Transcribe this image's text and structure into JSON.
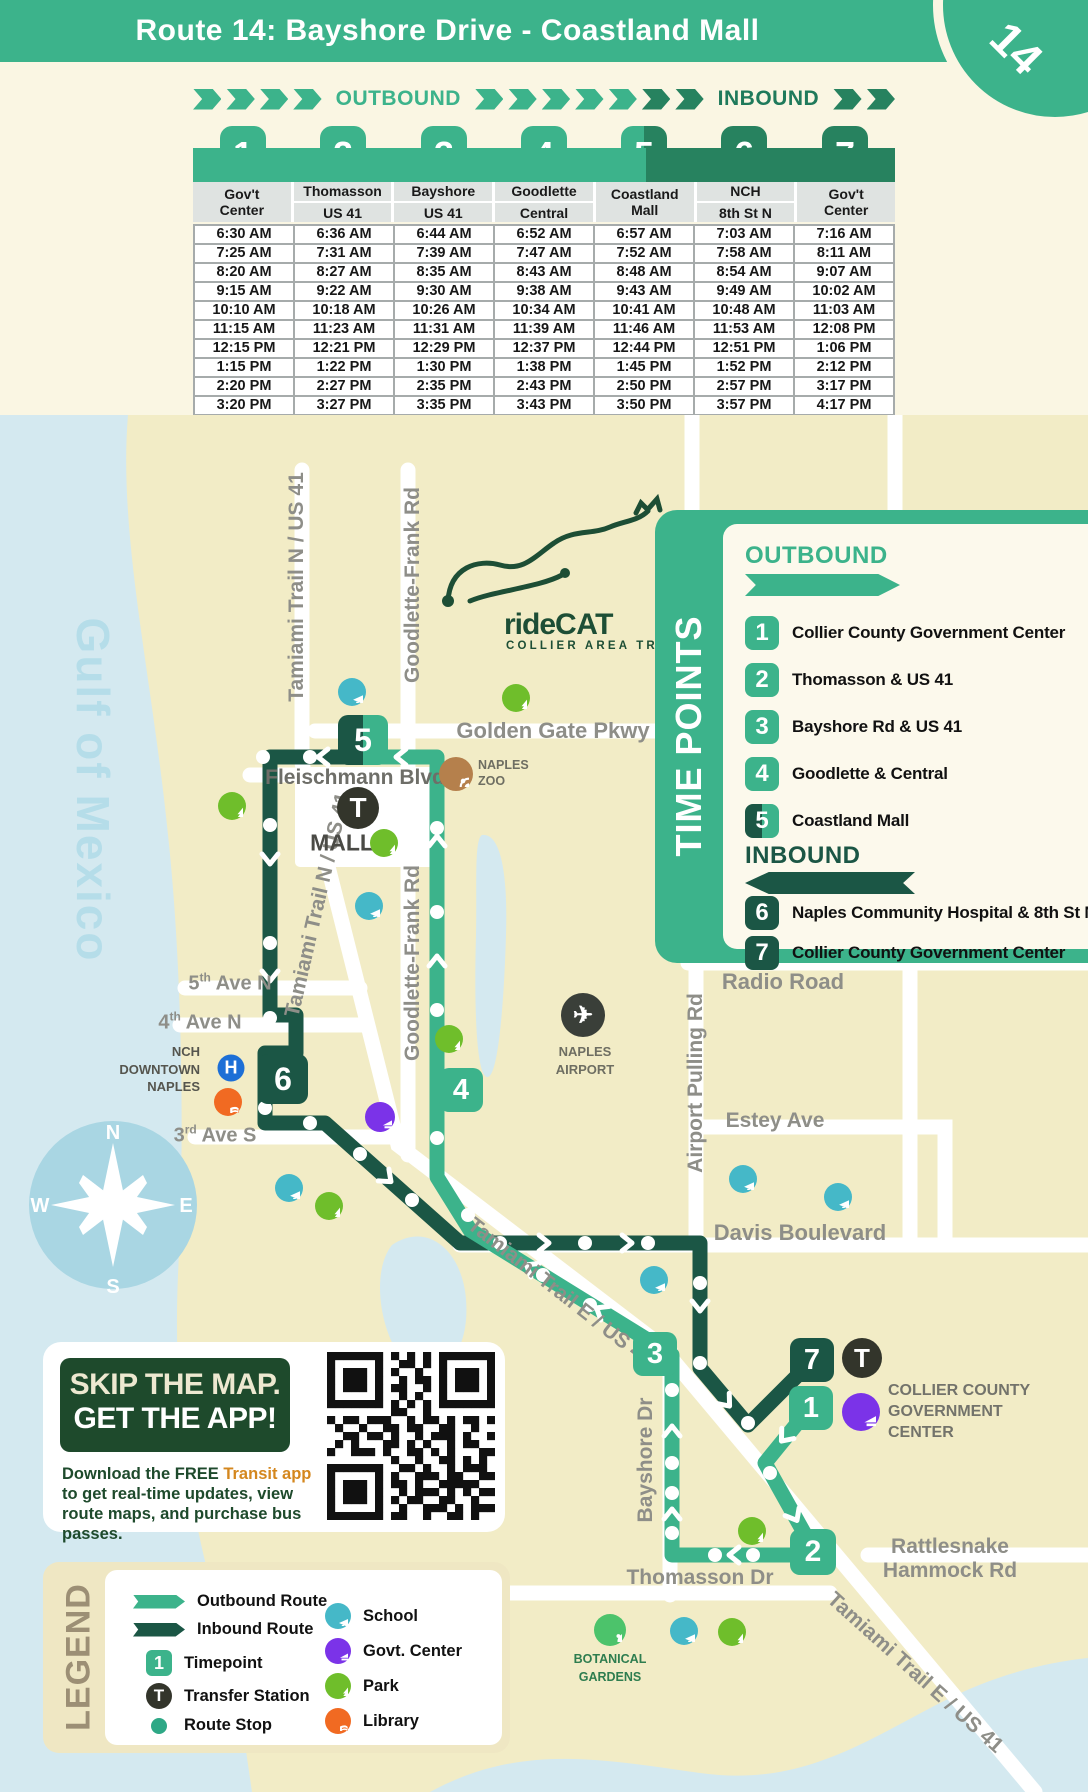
{
  "header": {
    "title": "Route 14: Bayshore Drive - Coastland Mall",
    "route_number": "14"
  },
  "directions": {
    "outbound": "OUTBOUND",
    "inbound": "INBOUND"
  },
  "schedule": {
    "columns": [
      {
        "num": "1",
        "line1": "Gov't",
        "line2": "Center"
      },
      {
        "num": "2",
        "line1": "Thomasson",
        "line2": "US 41"
      },
      {
        "num": "3",
        "line1": "Bayshore",
        "line2": "US 41"
      },
      {
        "num": "4",
        "line1": "Goodlette",
        "line2": "Central"
      },
      {
        "num": "5",
        "line1": "Coastland",
        "line2": "Mall"
      },
      {
        "num": "6",
        "line1": "NCH",
        "line2": "8th St N"
      },
      {
        "num": "7",
        "line1": "Gov't",
        "line2": "Center"
      }
    ],
    "rows": [
      [
        "6:30 AM",
        "6:36 AM",
        "6:44 AM",
        "6:52 AM",
        "6:57 AM",
        "7:03 AM",
        "7:16 AM"
      ],
      [
        "7:25 AM",
        "7:31 AM",
        "7:39 AM",
        "7:47 AM",
        "7:52 AM",
        "7:58 AM",
        "8:11 AM"
      ],
      [
        "8:20 AM",
        "8:27 AM",
        "8:35 AM",
        "8:43 AM",
        "8:48 AM",
        "8:54 AM",
        "9:07 AM"
      ],
      [
        "9:15 AM",
        "9:22 AM",
        "9:30 AM",
        "9:38 AM",
        "9:43 AM",
        "9:49 AM",
        "10:02 AM"
      ],
      [
        "10:10 AM",
        "10:18 AM",
        "10:26 AM",
        "10:34 AM",
        "10:41 AM",
        "10:48 AM",
        "11:03 AM"
      ],
      [
        "11:15 AM",
        "11:23 AM",
        "11:31 AM",
        "11:39 AM",
        "11:46 AM",
        "11:53 AM",
        "12:08 PM"
      ],
      [
        "12:15 PM",
        "12:21 PM",
        "12:29 PM",
        "12:37 PM",
        "12:44 PM",
        "12:51 PM",
        "1:06 PM"
      ],
      [
        "1:15 PM",
        "1:22 PM",
        "1:30 PM",
        "1:38 PM",
        "1:45 PM",
        "1:52 PM",
        "2:12 PM"
      ],
      [
        "2:20 PM",
        "2:27 PM",
        "2:35 PM",
        "2:43 PM",
        "2:50 PM",
        "2:57 PM",
        "3:17 PM"
      ],
      [
        "3:20 PM",
        "3:27 PM",
        "3:35 PM",
        "3:43 PM",
        "3:50 PM",
        "3:57 PM",
        "4:17 PM"
      ]
    ]
  },
  "timepoints": {
    "title": "TIME POINTS",
    "outbound_label": "OUTBOUND",
    "inbound_label": "INBOUND",
    "outbound": [
      {
        "num": "1",
        "label": "Collier County Government Center"
      },
      {
        "num": "2",
        "label": "Thomasson & US 41"
      },
      {
        "num": "3",
        "label": "Bayshore Rd & US 41"
      },
      {
        "num": "4",
        "label": "Goodlette & Central"
      },
      {
        "num": "5",
        "label": "Coastland Mall"
      }
    ],
    "inbound": [
      {
        "num": "6",
        "label": "Naples Community Hospital & 8th St N"
      },
      {
        "num": "7",
        "label": "Collier County Government Center"
      }
    ]
  },
  "map": {
    "water_label": "Gulf of Mexico",
    "compass": {
      "n": "N",
      "e": "E",
      "s": "S",
      "w": "W"
    },
    "logo": {
      "ride": "ride",
      "cat": "CAT",
      "tagline": "COLLIER AREA TRANSIT"
    },
    "labels": {
      "tamiami_n": "Tamiami Trail N / US 41",
      "tamiami_e": "Tamiami Trail E / US 41",
      "goodlette": "Goodlette-Frank Rd",
      "golden_gate": "Golden Gate Pkwy",
      "fleischmann": "Fleischmann  Blvd",
      "ave5": {
        "num": "5",
        "sup": "th",
        "rest": " Ave N"
      },
      "ave4": {
        "num": "4",
        "sup": "th",
        "rest": " Ave N"
      },
      "ave3": {
        "num": "3",
        "sup": "rd",
        "rest": " Ave S"
      },
      "radio": "Radio Road",
      "airport_pulling": "Airport Pulling Rd",
      "estey": "Estey Ave",
      "davis": "Davis Boulevard",
      "bayshore": "Bayshore Dr",
      "thomasson": "Thomasson Dr",
      "rattlesnake": {
        "l1": "Rattlesnake",
        "l2": "Hammock Rd"
      },
      "mall": "MALL",
      "zoo": {
        "l1": "NAPLES",
        "l2": "ZOO"
      },
      "nch": {
        "l1": "NCH",
        "l2": "DOWNTOWN",
        "l3": "NAPLES"
      },
      "airport": {
        "l1": "NAPLES",
        "l2": "AIRPORT"
      },
      "gov_center": {
        "l1": "COLLIER COUNTY",
        "l2": "GOVERNMENT",
        "l3": "CENTER"
      },
      "botanical": {
        "l1": "BOTANICAL",
        "l2": "GARDENS"
      },
      "hospital_letter": "H",
      "transfer_letter": "T"
    }
  },
  "app_card": {
    "headline_1": "SKIP THE MAP.",
    "headline_2": "GET THE APP!",
    "body_prefix": "Download the FREE ",
    "body_link": "Transit app",
    "body_suffix": " to get real-time updates, view route maps, and purchase bus passes."
  },
  "legend": {
    "title": "LEGEND",
    "outbound_route": "Outbound Route",
    "inbound_route": "Inbound Route",
    "timepoint": "Timepoint",
    "timepoint_sample": "1",
    "transfer": "Transfer Station",
    "transfer_letter": "T",
    "route_stop": "Route Stop",
    "school": "School",
    "govt_center": "Govt. Center",
    "park": "Park",
    "library": "Library"
  },
  "colors": {
    "brand_green": "#3CB38B",
    "dark_green": "#1B5645",
    "chevron_dark": "#27825F",
    "page_cream": "#FAF6E3",
    "land": "#F2ECC6",
    "water": "#D4E9F0",
    "school": "#45B8C8",
    "govt_center": "#7B33E8",
    "park": "#6FBE2B",
    "library": "#F16A22",
    "hospital": "#1D6FD6",
    "zoo": "#B5804C",
    "botanical": "#4CC36B",
    "airport": "#3A3F39",
    "transfer": "#33352B",
    "app_green": "#1E4A2C",
    "transit_orange": "#D4871E",
    "legend_tan": "#EFE7C3"
  }
}
